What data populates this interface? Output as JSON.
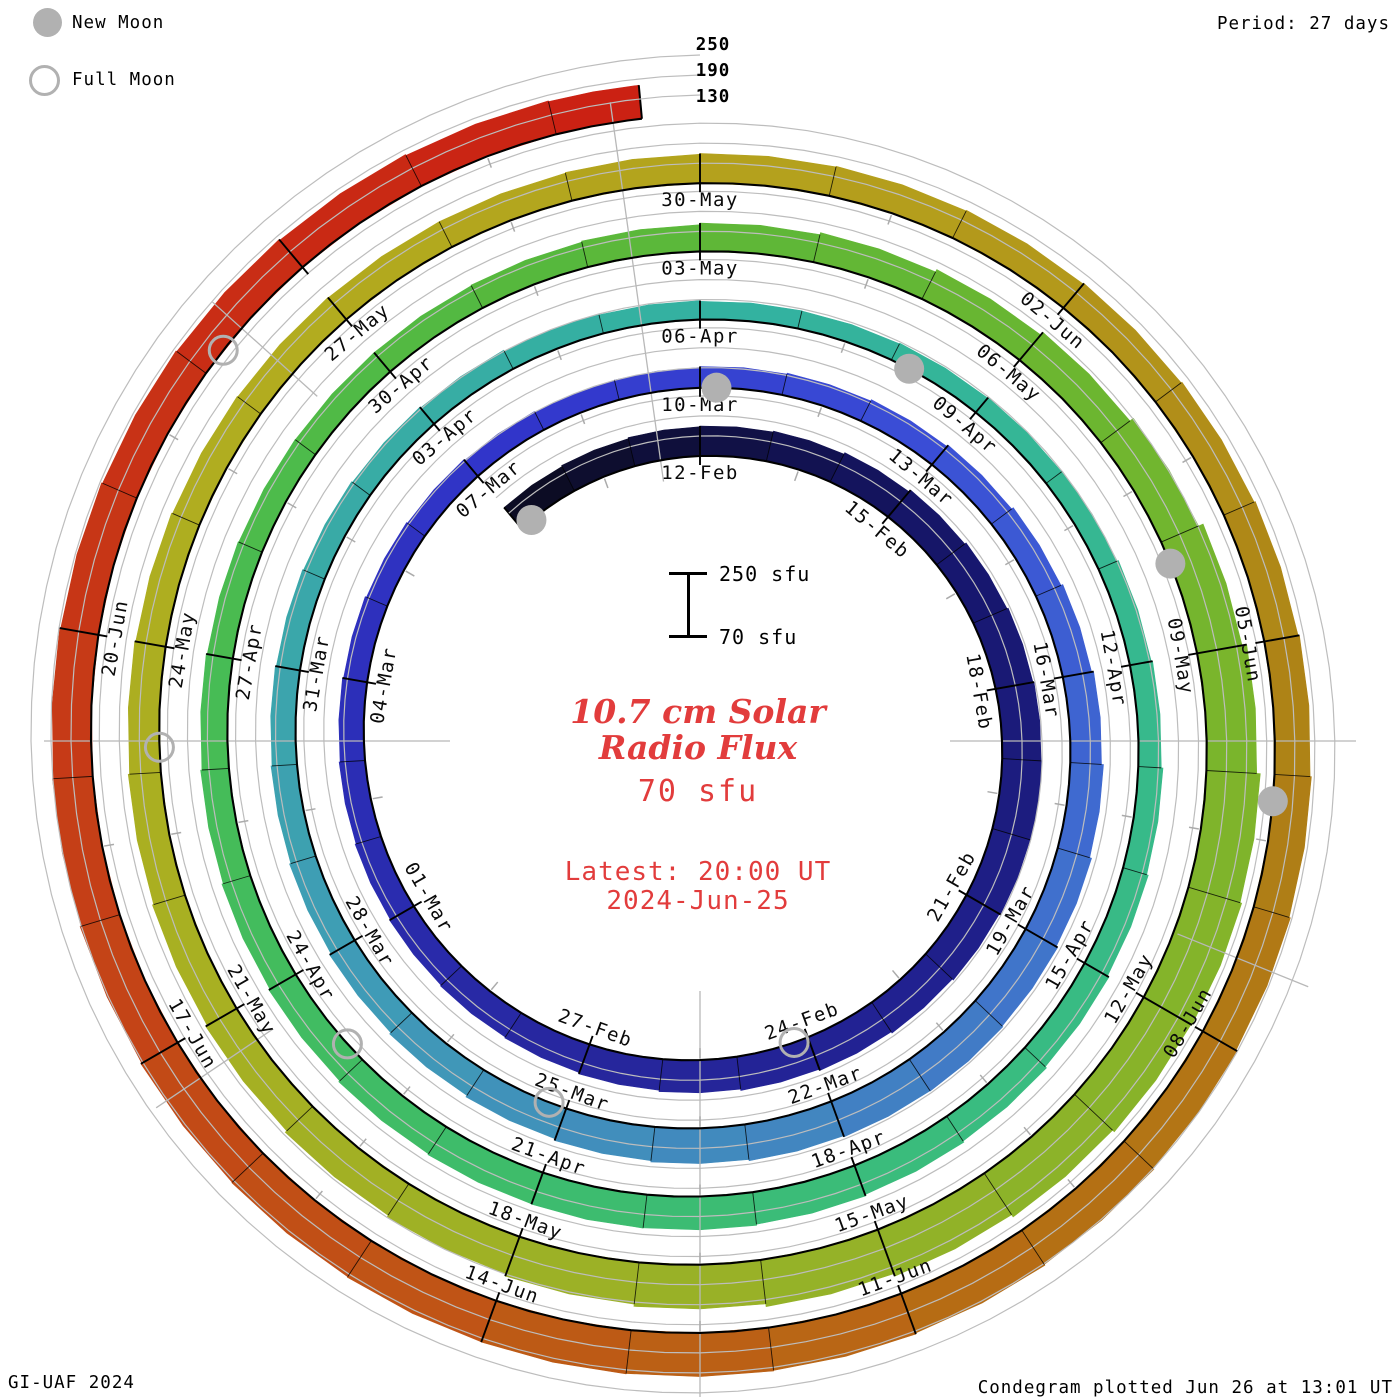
{
  "legend": {
    "new_moon_label": "New Moon",
    "full_moon_label": "Full Moon"
  },
  "header": {
    "period_label": "Period: 27 days"
  },
  "footer": {
    "credit": "GI-UAF 2024",
    "plotted": "Condegram plotted Jun 26 at 13:01 UT"
  },
  "center": {
    "title_line1": "10.7 cm Solar",
    "title_line2": "Radio Flux",
    "baseline_label": "70 sfu",
    "latest_line1": "Latest: 20:00 UT",
    "latest_line2": "2024-Jun-25"
  },
  "scale_bar": {
    "top_label": "250 sfu",
    "bottom_label": "70 sfu"
  },
  "radial_axis_labels": [
    "250",
    "190",
    "130"
  ],
  "colors": {
    "accent_red": "#e23c3c",
    "moon_gray": "#b1b1b1",
    "grid_gray": "#bdbdbd",
    "radial_gray": "#b8b8b8",
    "baseline_black": "#000000"
  },
  "chart_data": {
    "type": "bar",
    "projection": "spiral-condegram",
    "title": "10.7 cm Solar Radio Flux",
    "units": "sfu",
    "period_days": 27,
    "start_date": "2024-02-09",
    "end_date": "2024-06-25",
    "baseline_sfu": 70,
    "grid_levels_sfu": [
      130,
      190,
      250
    ],
    "tick_interval_days": 3,
    "layout": {
      "direction": "clockwise",
      "top_anchor_label": "12-Feb",
      "grid": "on",
      "legend_position": "top-left"
    },
    "tick_labels": [
      "12-Feb",
      "15-Feb",
      "18-Feb",
      "21-Feb",
      "24-Feb",
      "27-Feb",
      "01-Mar",
      "04-Mar",
      "07-Mar",
      "10-Mar",
      "13-Mar",
      "16-Mar",
      "19-Mar",
      "22-Mar",
      "25-Mar",
      "28-Mar",
      "31-Mar",
      "03-Apr",
      "06-Apr",
      "09-Apr",
      "12-Apr",
      "15-Apr",
      "18-Apr",
      "21-Apr",
      "24-Apr",
      "27-Apr",
      "30-Apr",
      "03-May",
      "06-May",
      "09-May",
      "12-May",
      "15-May",
      "18-May",
      "21-May",
      "24-May",
      "27-May",
      "30-May",
      "02-Jun",
      "05-Jun",
      "08-Jun",
      "11-Jun",
      "14-Jun",
      "17-Jun",
      "20-Jun"
    ],
    "values_sfu": [
      152,
      155,
      158,
      160,
      163,
      168,
      175,
      180,
      184,
      187,
      190,
      188,
      184,
      180,
      176,
      172,
      168,
      164,
      160,
      157,
      154,
      151,
      148,
      145,
      142,
      138,
      135,
      132,
      130,
      131,
      134,
      137,
      141,
      146,
      152,
      158,
      164,
      170,
      176,
      181,
      184,
      183,
      180,
      176,
      172,
      167,
      162,
      157,
      152,
      148,
      145,
      142,
      139,
      136,
      133,
      130,
      127,
      125,
      124,
      126,
      128,
      131,
      135,
      139,
      144,
      149,
      154,
      159,
      163,
      167,
      170,
      171,
      170,
      167,
      163,
      159,
      155,
      151,
      148,
      146,
      145,
      145,
      147,
      150,
      155,
      161,
      169,
      179,
      192,
      207,
      221,
      232,
      237,
      234,
      227,
      219,
      211,
      203,
      196,
      189,
      183,
      177,
      172,
      168,
      164,
      161,
      158,
      156,
      155,
      155,
      157,
      159,
      161,
      163,
      166,
      169,
      173,
      177,
      181,
      185,
      189,
      193,
      196,
      199,
      201,
      202,
      201,
      199,
      197,
      194,
      191,
      188,
      185,
      182,
      179,
      176,
      173,
      171
    ],
    "new_moons": [
      {
        "date": "2024-02-09",
        "day": 0
      },
      {
        "date": "2024-03-10",
        "day": 30
      },
      {
        "date": "2024-04-08",
        "day": 59
      },
      {
        "date": "2024-05-08",
        "day": 89
      },
      {
        "date": "2024-06-06",
        "day": 118
      }
    ],
    "full_moons": [
      {
        "date": "2024-02-24",
        "day": 15
      },
      {
        "date": "2024-03-25",
        "day": 45
      },
      {
        "date": "2024-04-23",
        "day": 74
      },
      {
        "date": "2024-05-23",
        "day": 104
      },
      {
        "date": "2024-06-22",
        "day": 134
      }
    ],
    "colormap": [
      [
        0.0,
        "#0c0c24"
      ],
      [
        0.045,
        "#16166a"
      ],
      [
        0.095,
        "#212190"
      ],
      [
        0.125,
        "#26269c"
      ],
      [
        0.16,
        "#2b2db4"
      ],
      [
        0.2,
        "#3236cc"
      ],
      [
        0.235,
        "#3a4ed6"
      ],
      [
        0.27,
        "#3f6ad0"
      ],
      [
        0.307,
        "#4286c0"
      ],
      [
        0.345,
        "#3f9cb6"
      ],
      [
        0.38,
        "#39aaa6"
      ],
      [
        0.415,
        "#33b2a0"
      ],
      [
        0.45,
        "#36b890"
      ],
      [
        0.49,
        "#39bc80"
      ],
      [
        0.526,
        "#3ebc6a"
      ],
      [
        0.563,
        "#47bc54"
      ],
      [
        0.6,
        "#57b83c"
      ],
      [
        0.635,
        "#6cb630"
      ],
      [
        0.672,
        "#84b42a"
      ],
      [
        0.708,
        "#99b127"
      ],
      [
        0.745,
        "#a8b022"
      ],
      [
        0.78,
        "#b2ac1f"
      ],
      [
        0.818,
        "#b49e1c"
      ],
      [
        0.855,
        "#ae8216"
      ],
      [
        0.89,
        "#b66c14"
      ],
      [
        0.92,
        "#c05416"
      ],
      [
        0.956,
        "#c63a17"
      ],
      [
        1.0,
        "#cb2113"
      ]
    ],
    "radial_guide_angles_deg": [
      90,
      112,
      180,
      236,
      270,
      312,
      352
    ]
  }
}
